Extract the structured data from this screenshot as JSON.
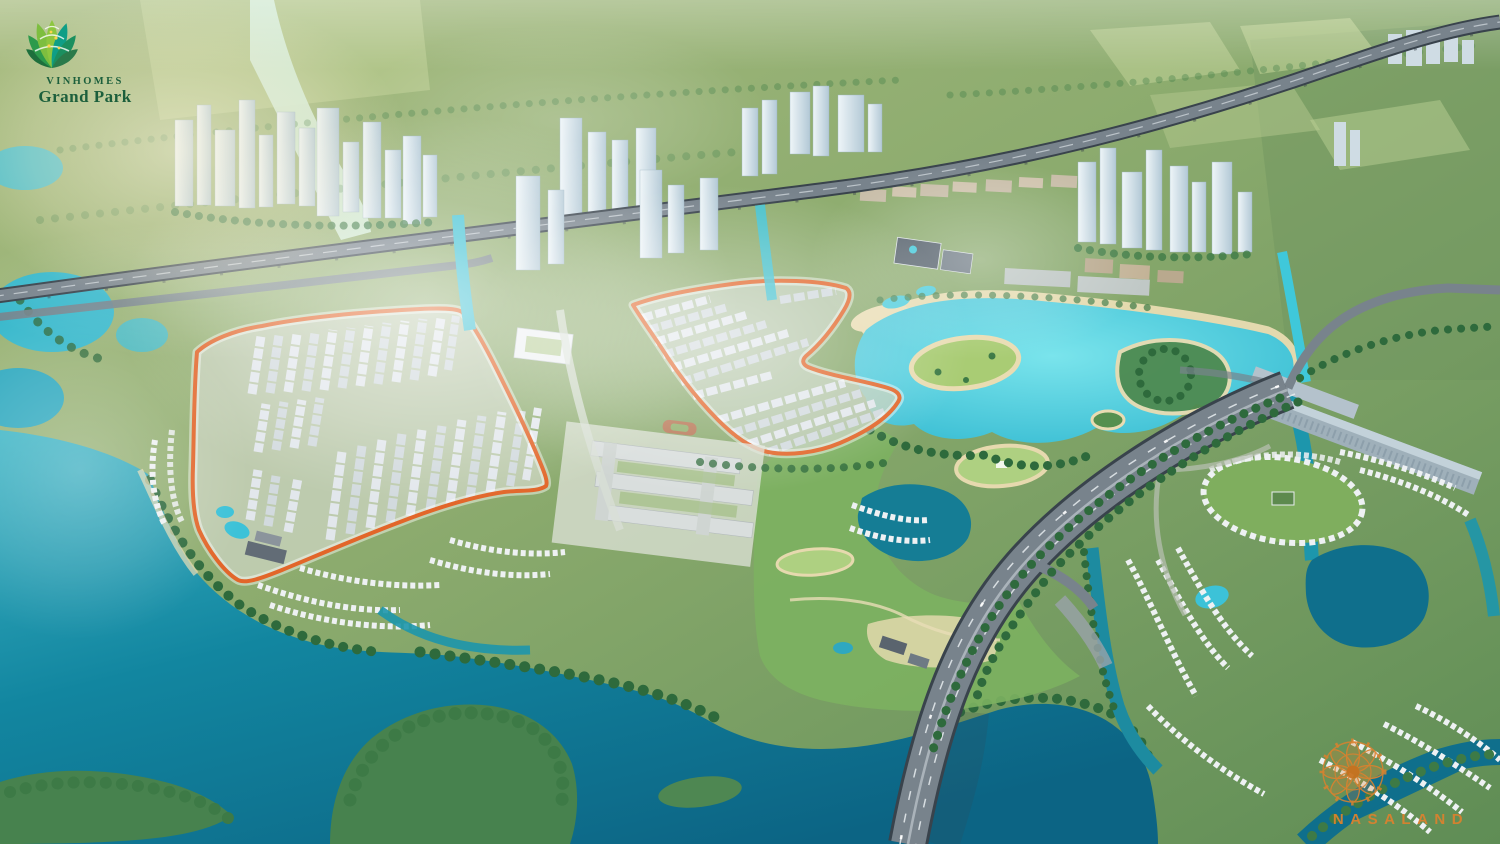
{
  "watermarks": {
    "vinhomes": {
      "brand": "VINHOMES",
      "project": "Grand Park"
    },
    "nasaland": {
      "brand": "NASALAND"
    }
  },
  "colors": {
    "boundary_orange": "#e2662a",
    "water_bright": "#35c2d8",
    "water_mid": "#1d96ac",
    "water_deep": "#0f6f8c",
    "sand": "#e9dcb2",
    "green_base": "#8aa76d",
    "green_park": "#7cb161",
    "green_dark": "#33663c",
    "road_gray": "#78838c",
    "deck_dark": "#39434c",
    "roof_light": "#e2e7ec",
    "tower_light": "#dfeaf0",
    "tower_shade": "#b3c9d6",
    "brand_green": "#1c5f3c",
    "brand_green_mid": "#2e9e4f",
    "brand_lime": "#8dc63f",
    "brand_teal": "#0f9e86",
    "brand_yellow": "#ffd34d",
    "nasaland_orange": "#d9822f"
  }
}
